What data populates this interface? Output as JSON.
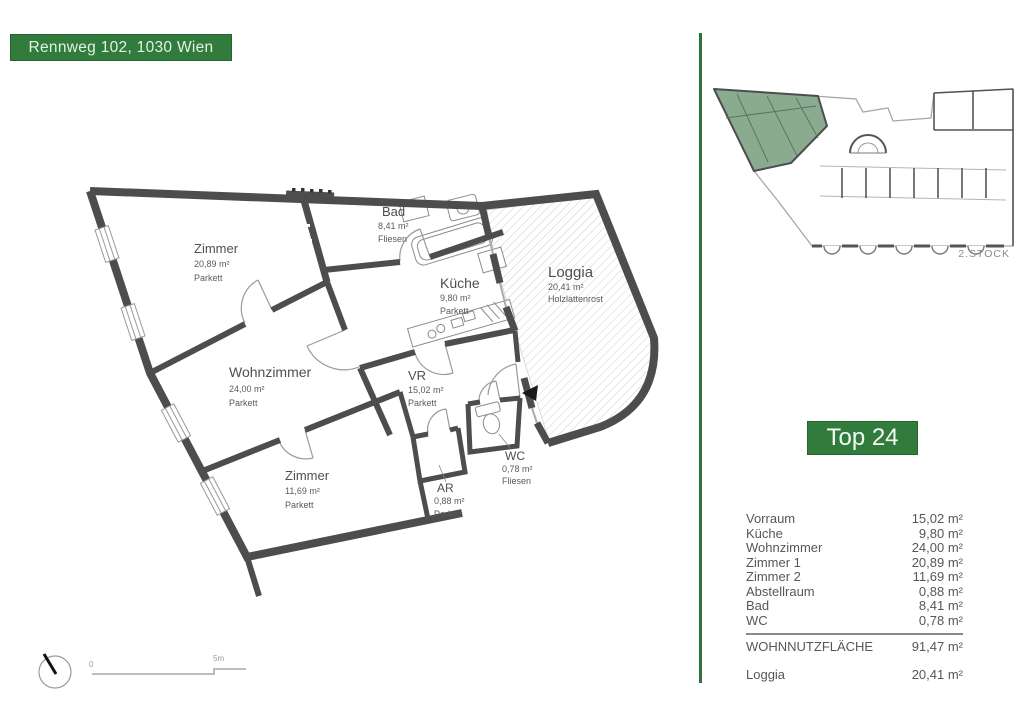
{
  "header": {
    "address": "Rennweg 102, 1030 Wien"
  },
  "unit": {
    "badge": "Top 24"
  },
  "overview": {
    "floor_label": "2.STOCK"
  },
  "floorplan": {
    "rooms": [
      {
        "name": "Zimmer",
        "area": "20,89 m²",
        "floor": "Parkett"
      },
      {
        "name": "Wohnzimmer",
        "area": "24,00 m²",
        "floor": "Parkett"
      },
      {
        "name": "Zimmer",
        "area": "11,69 m²",
        "floor": "Parkett"
      },
      {
        "name": "Bad",
        "area": "8,41 m²",
        "floor": "Fliesen"
      },
      {
        "name": "Küche",
        "area": "9,80 m²",
        "floor": "Parkett"
      },
      {
        "name": "VR",
        "area": "15,02 m²",
        "floor": "Parkett"
      },
      {
        "name": "WC",
        "area": "0,78 m²",
        "floor": "Fliesen"
      },
      {
        "name": "AR",
        "area": "0,88 m²",
        "floor": "Parkett"
      },
      {
        "name": "Loggia",
        "area": "20,41 m²",
        "floor": "Holzlattenrost"
      }
    ]
  },
  "scalebar": {
    "zero": "0",
    "five": "5m"
  },
  "area_table": {
    "rows": [
      {
        "label": "Vorraum",
        "value": "15,02 m²"
      },
      {
        "label": "Küche",
        "value": "9,80 m²"
      },
      {
        "label": "Wohnzimmer",
        "value": "24,00 m²"
      },
      {
        "label": "Zimmer 1",
        "value": "20,89 m²"
      },
      {
        "label": "Zimmer 2",
        "value": "11,69 m²"
      },
      {
        "label": "Abstellraum",
        "value": "0,88 m²"
      },
      {
        "label": "Bad",
        "value": "8,41 m²"
      },
      {
        "label": "WC",
        "value": "0,78 m²"
      }
    ],
    "total": {
      "label": "WOHNNUTZFLÄCHE",
      "value": "91,47 m²"
    },
    "outdoor": {
      "label": "Loggia",
      "value": "20,41 m²"
    }
  },
  "colors": {
    "accent_green": "#317c3c",
    "divider_green": "#2e7439",
    "unit_highlight_green": "#8aab90",
    "wall_gray": "#4d4d4d"
  }
}
